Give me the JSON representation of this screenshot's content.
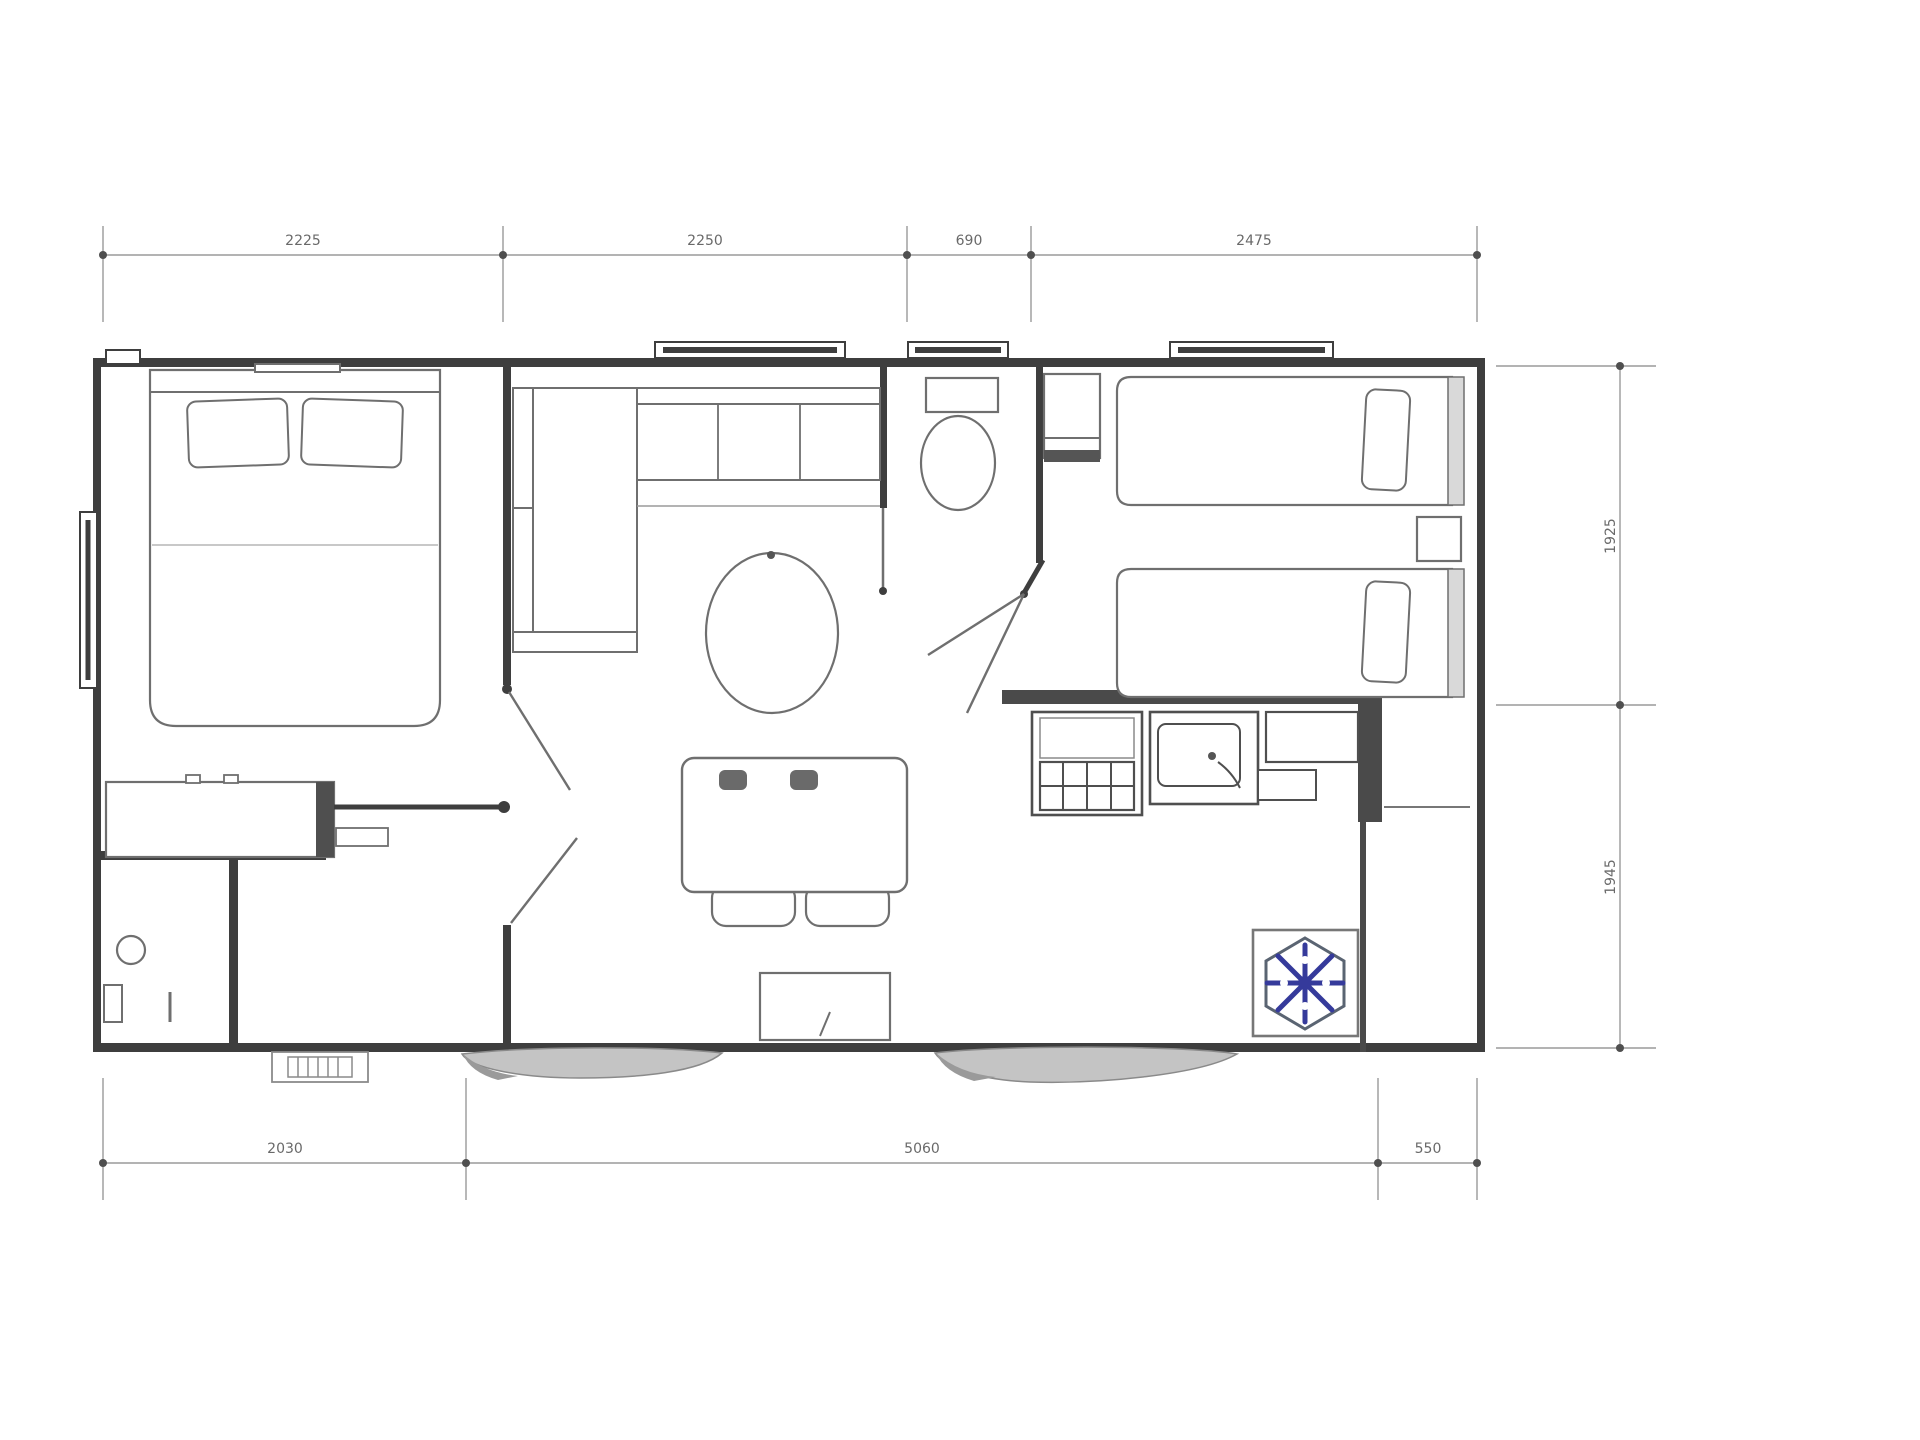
{
  "drawing": {
    "type": "mobile-home-floor-plan",
    "rooms": [
      "master-bedroom",
      "bathroom",
      "living-dining",
      "wc",
      "kitchen",
      "twin-bedroom"
    ]
  },
  "dimensions": {
    "top": {
      "seg1": "2225",
      "seg2": "2250",
      "seg3": "690",
      "seg4": "2475"
    },
    "bottom": {
      "seg1": "2030",
      "seg2": "5060",
      "seg3": "550"
    },
    "right": {
      "seg1": "1925",
      "seg2": "1945"
    }
  },
  "icons": {
    "ac_unit": "snowflake-icon"
  },
  "colors": {
    "wall": "#3e3e3e",
    "furniture": "#6f6f6f",
    "dimension_line": "#9a9a9a",
    "dimension_text": "#4f4f4f",
    "ac_blue": "#353a9b",
    "hexagon_gray": "#5a6472",
    "step_gray": "#c4c4c4",
    "background": "#ffffff"
  }
}
